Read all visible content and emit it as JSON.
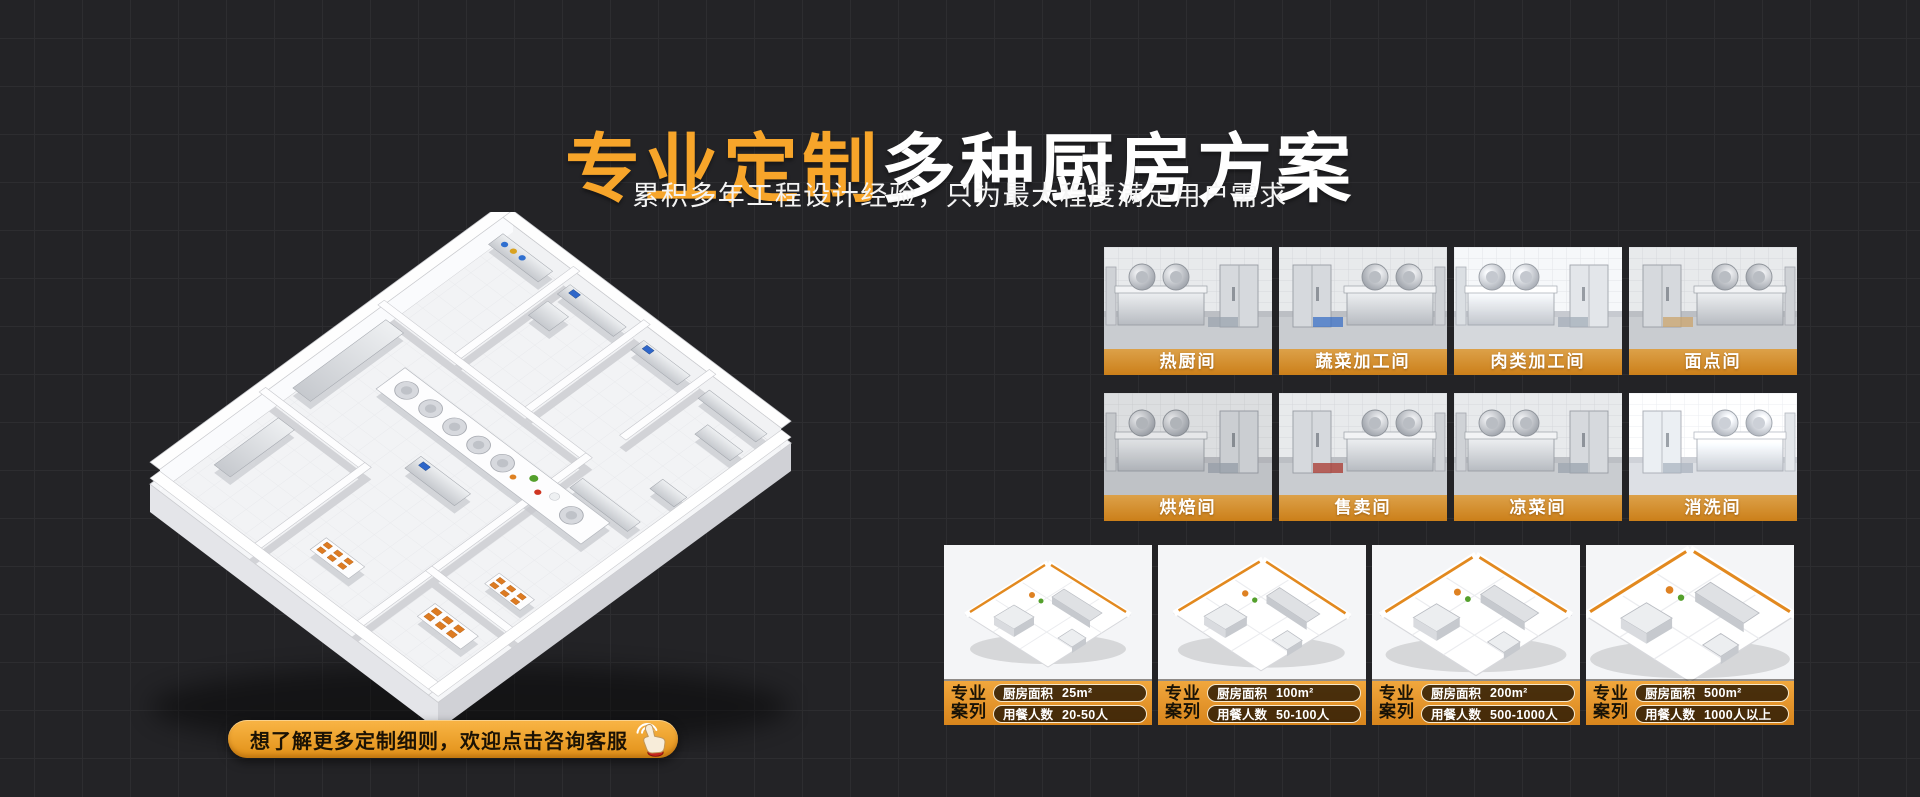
{
  "page": {
    "background_color": "#232326",
    "grid_line_color": "#2d2d30",
    "accent_color": "#F7A52A"
  },
  "hero": {
    "title_highlight": "专业定制",
    "title_rest": "多种厨房方案",
    "subtitle": "累积多年工程设计经验，只为最大程度满足用户需求"
  },
  "floor_plan": {
    "icon": "isometric-kitchen-floorplan-render"
  },
  "cta": {
    "label": "想了解更多定制细则，欢迎点击咨询客服",
    "icon": "hand-click-icon"
  },
  "rooms": {
    "items": [
      {
        "label": "热厨间"
      },
      {
        "label": "蔬菜加工间"
      },
      {
        "label": "肉类加工间"
      },
      {
        "label": "面点间"
      },
      {
        "label": "烘焙间"
      },
      {
        "label": "售卖间"
      },
      {
        "label": "凉菜间"
      },
      {
        "label": "消洗间"
      }
    ]
  },
  "cases": {
    "badge_line1": "专业",
    "badge_line2": "案列",
    "bar_color": "#E49A2E",
    "pill_bg": "#2D1B05",
    "pill_border": "#F6EAD0",
    "items": [
      {
        "area_label": "厨房面积",
        "area_value": "25m²",
        "diners_label": "用餐人数",
        "diners_value": "20-50人"
      },
      {
        "area_label": "厨房面积",
        "area_value": "100m²",
        "diners_label": "用餐人数",
        "diners_value": "50-100人"
      },
      {
        "area_label": "厨房面积",
        "area_value": "200m²",
        "diners_label": "用餐人数",
        "diners_value": "500-1000人"
      },
      {
        "area_label": "厨房面积",
        "area_value": "500m²",
        "diners_label": "用餐人数",
        "diners_value": "1000人以上"
      }
    ]
  }
}
